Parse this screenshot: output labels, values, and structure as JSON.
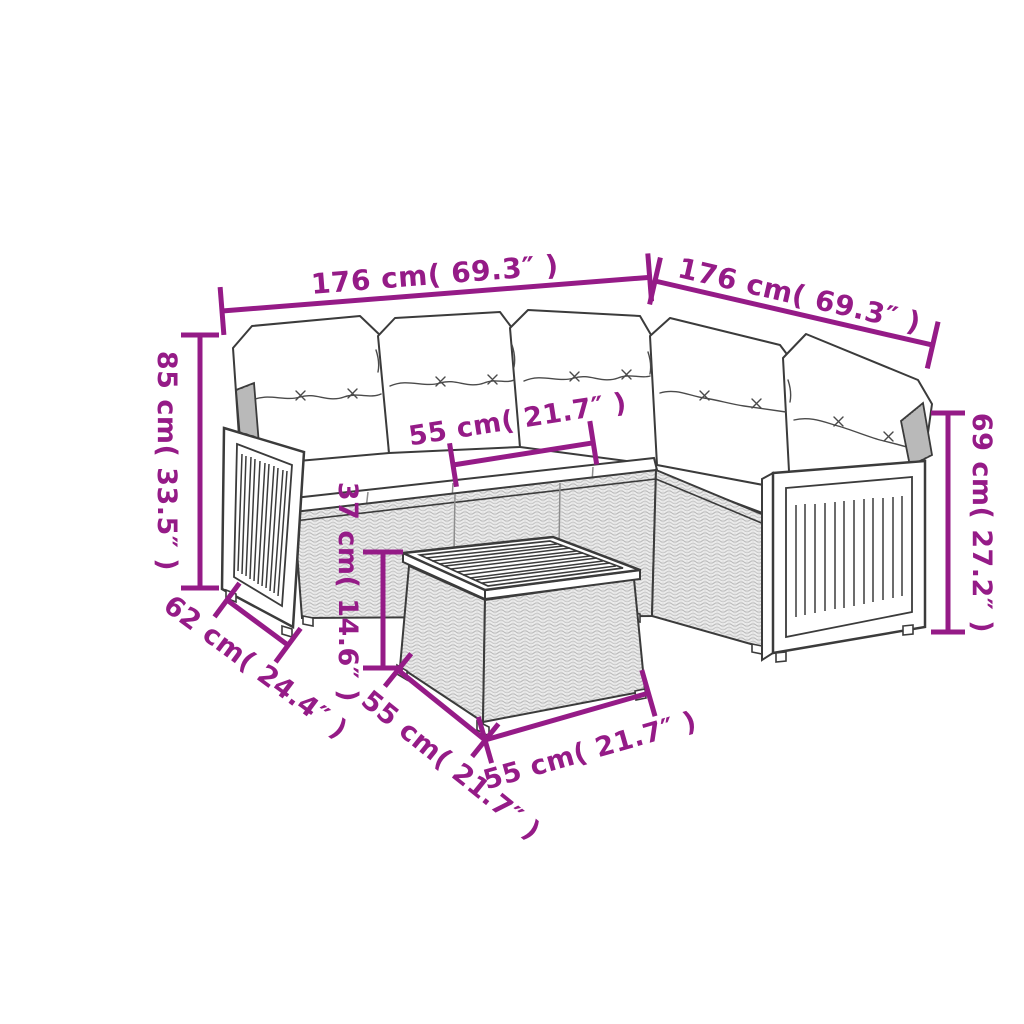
{
  "diagram": {
    "colors": {
      "dimension_accent": "#951b87",
      "drawing_outline": "#3b3b3b",
      "background": "#ffffff"
    },
    "annotations": {
      "sofa_side_left": "176 cm( 69.3″ )",
      "sofa_side_right": "176 cm( 69.3″ )",
      "back_height": "85 cm( 33.5″ )",
      "seat_width": "55 cm( 21.7″ )",
      "table_height": "37 cm( 14.6″ )",
      "armrest_height": "69 cm( 27.2″ )",
      "seat_depth": "62 cm( 24.4″ )",
      "table_depth": "55 cm( 21.7″ )",
      "table_width": "55 cm( 21.7″ )"
    }
  }
}
